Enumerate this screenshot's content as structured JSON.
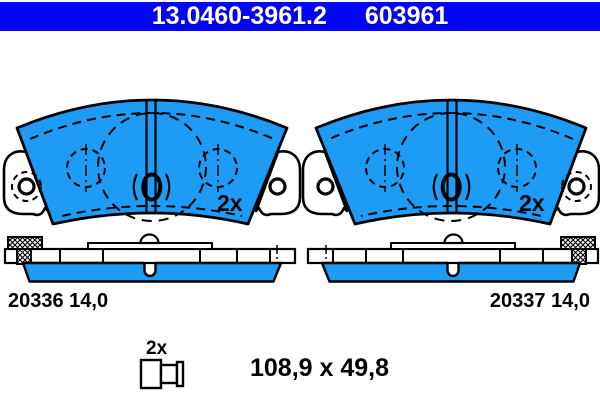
{
  "header": {
    "part_number": "13.0460-3961.2",
    "reference_number": "603961"
  },
  "colors": {
    "header_bg": "#0404f8",
    "pad_blue": "#1d9bf5",
    "line": "#000000",
    "header_text": "#ffffff",
    "background": "#ffffff"
  },
  "front_views": {
    "left_quantity": "2x",
    "right_quantity": "2x"
  },
  "side_views": {
    "left_label": "20336 14,0",
    "right_label": "20337 14,0"
  },
  "accessories": {
    "quantity": "2x"
  },
  "pad_dimensions": "108,9 x 49,8"
}
